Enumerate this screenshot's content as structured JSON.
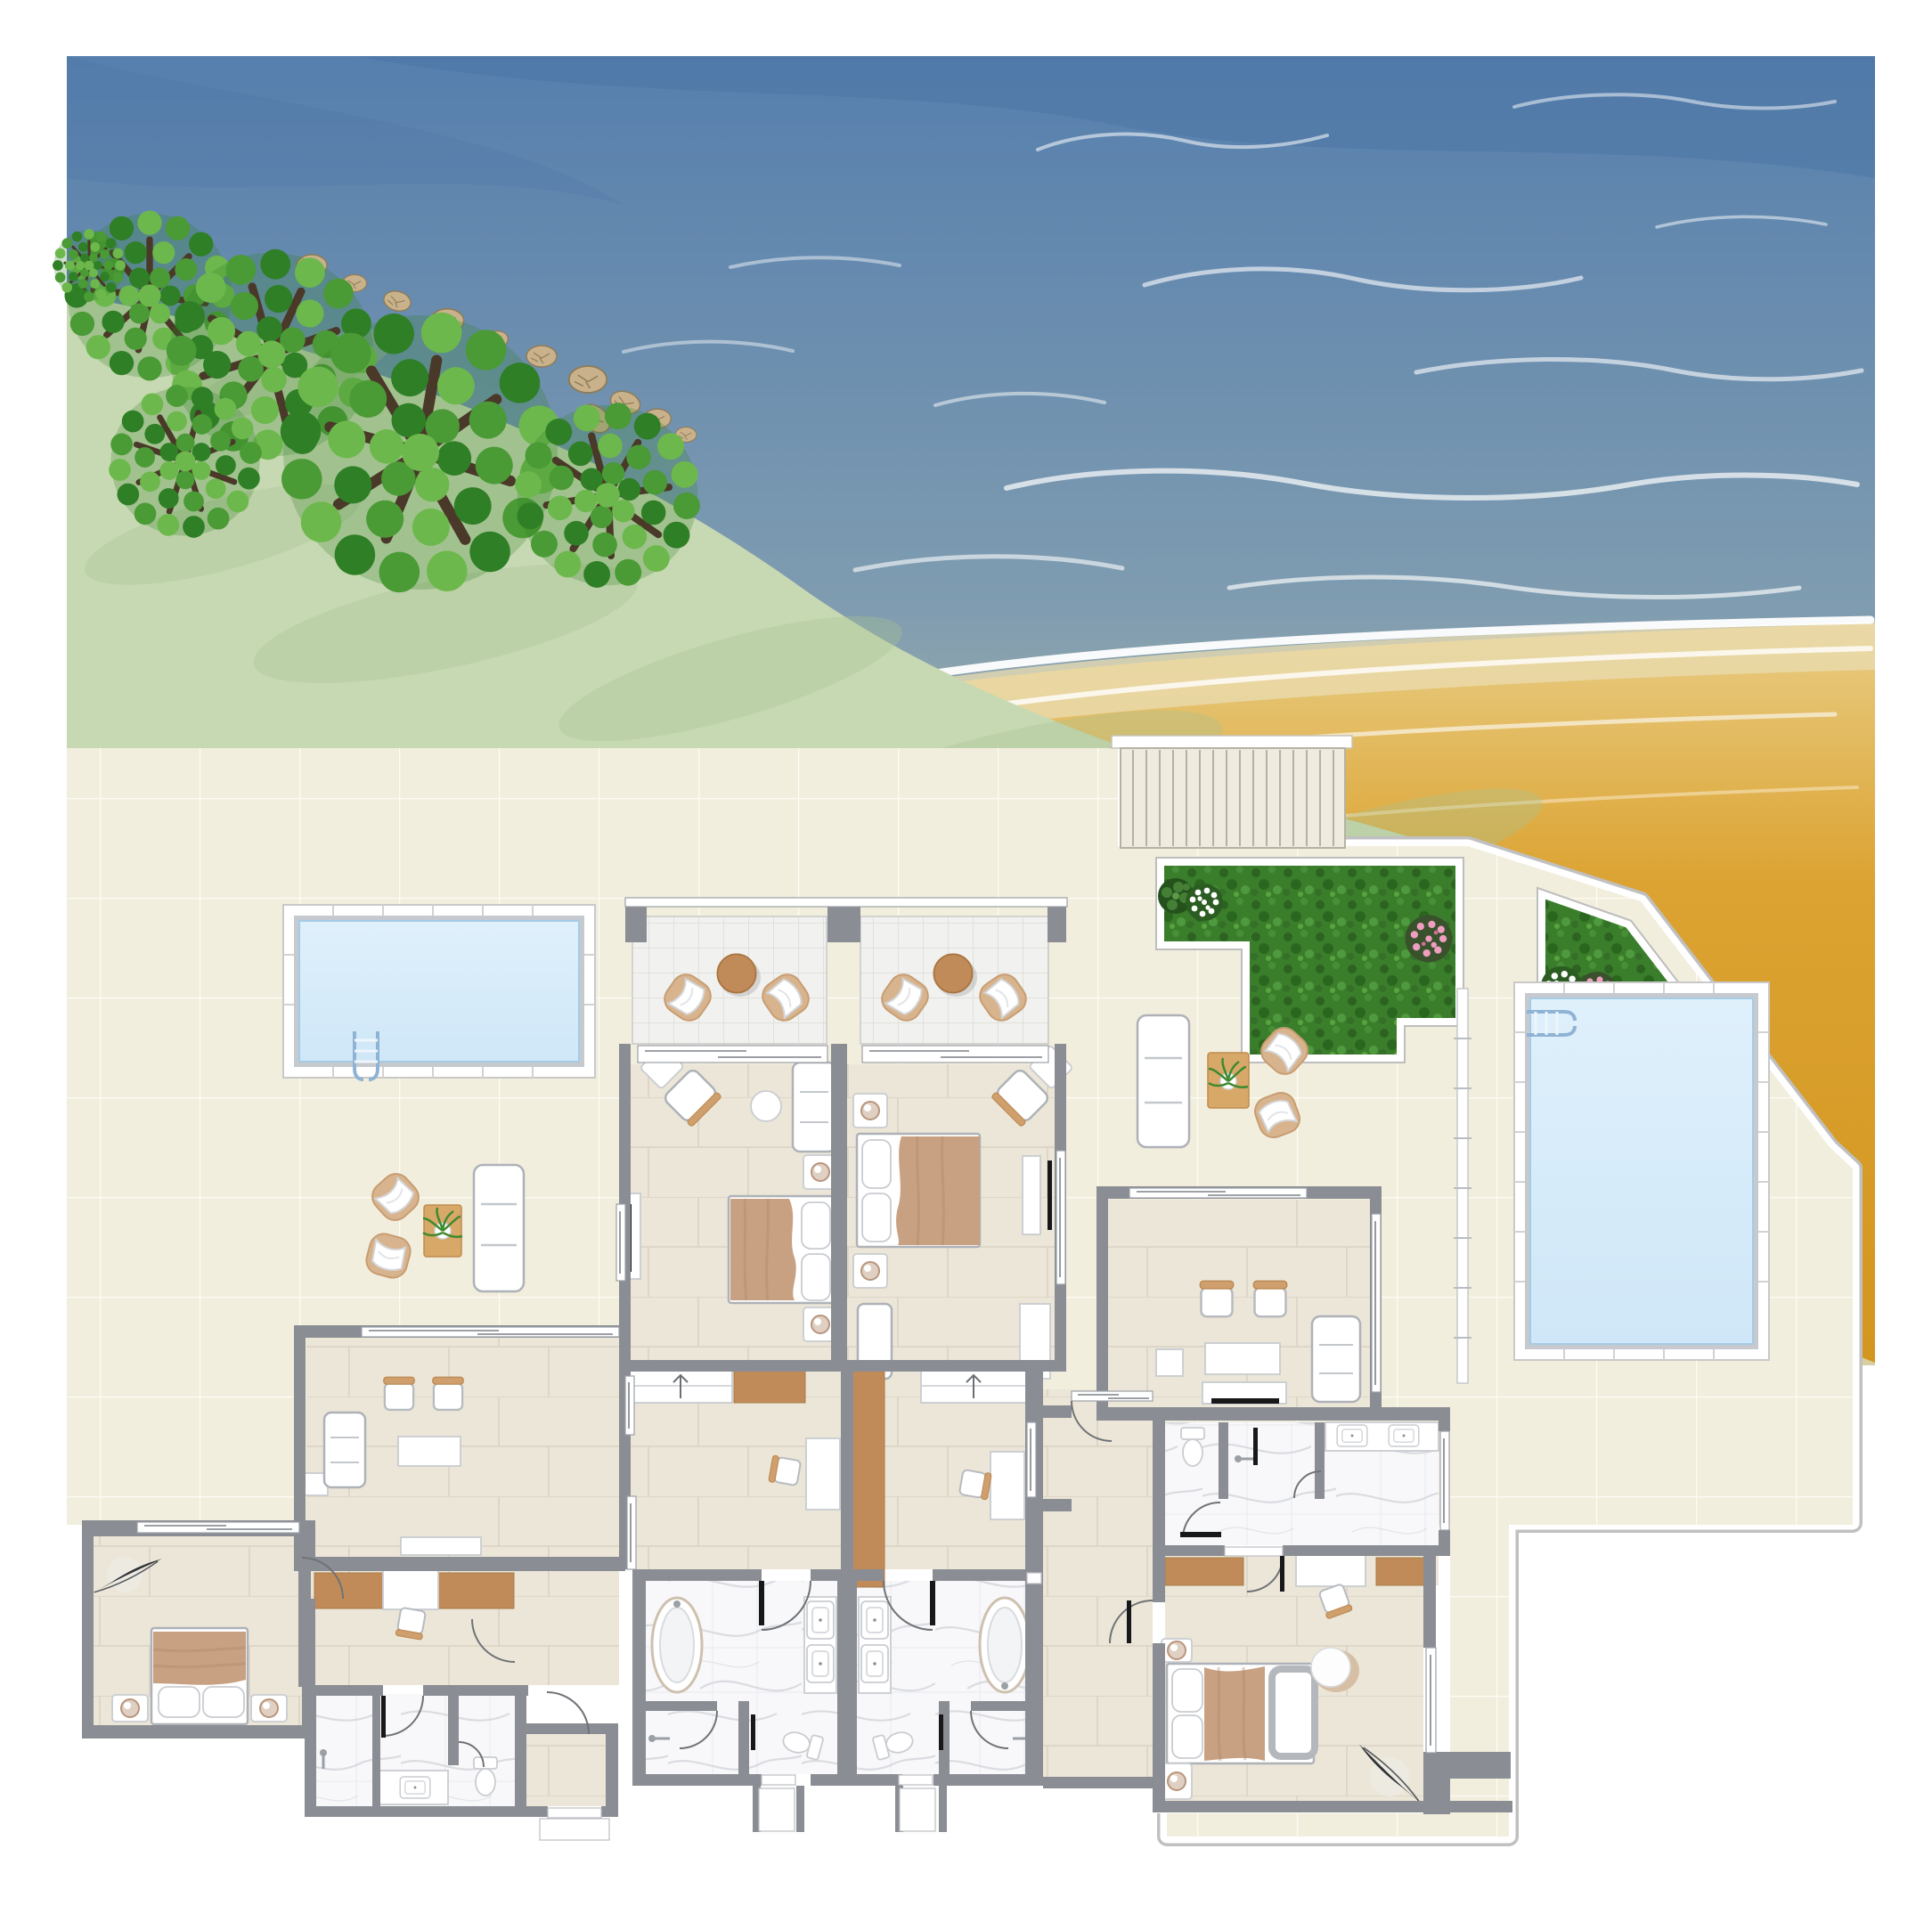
{
  "scene": {
    "title": "Beachfront villa floor plan - aerial illustration",
    "image_type": "architectural floor plan illustration, top view, no text labels",
    "environment": [
      "sea with white wave foam",
      "green hillside with trees and rocks",
      "sandy beach",
      "tiled terrace",
      "staircase down to beach",
      "two lawn patches with flowering shrubs"
    ],
    "pools": {
      "count": 2,
      "left_pool": "horizontal rectangle with ladder bottom-left",
      "right_pool": "vertical rectangle with ladder top-left"
    },
    "suites": [
      {
        "name": "left-suite",
        "rooms": [
          "living room",
          "corridor with wardrobe and desk",
          "bathroom",
          "entry vestibule",
          "bedroom"
        ]
      },
      {
        "name": "center-left-suite",
        "rooms": [
          "balcony",
          "bedroom",
          "dressing corridor",
          "marble bathroom with tub"
        ]
      },
      {
        "name": "center-right-suite",
        "rooms": [
          "balcony",
          "bedroom",
          "dressing corridor",
          "marble bathroom with tub"
        ]
      },
      {
        "name": "right-suite",
        "rooms": [
          "living room",
          "marble bathroom",
          "dressing corridor",
          "bedroom",
          "hall"
        ]
      }
    ],
    "furniture_counts": {
      "beds": 4,
      "balcony_armchairs": 4,
      "balcony_round_tables": 2,
      "terrace_armchairs": 4,
      "terrace_sofas": 2,
      "indoor_sofas": 4,
      "bathtubs": 2,
      "toilets": 4,
      "sinks": 7,
      "desks": 4,
      "wardrobes": 7,
      "tv_units": 4,
      "plants": 6
    }
  },
  "palette": {
    "wall": "#8a8d93",
    "terrace": "#f2eedd",
    "floor": "#ece6d8",
    "floorline": "#dcd5c6",
    "balconyfloor": "#f1f1ef",
    "balconyline": "#dadad6",
    "marble": "#f8f8fa",
    "vein": "#c9cdd4",
    "sea1": "#567fae",
    "sea2": "#7f9cb0",
    "sea3": "#c2c2a4",
    "foam": "#ffffff",
    "sand1": "#e8cd85",
    "sand2": "#dca332",
    "hill": "#c7d9b2",
    "hilldark": "#a8c492",
    "leaf1": "#6db84c",
    "leaf2": "#4a9a35",
    "leaf3": "#2f7f26",
    "branch": "#4a3829",
    "rock": "#c9b28b",
    "rockdark": "#8e7b57",
    "grass": "#3a7e2c",
    "grassdark": "#2c6321",
    "water": "#cfe7f8",
    "poolrim": "#c6cacf",
    "wood": "#c08b59",
    "rug": "#d8a869",
    "blanket": "#c8a183",
    "stair": "#efecdf",
    "stairline": "#b5b2a5"
  }
}
